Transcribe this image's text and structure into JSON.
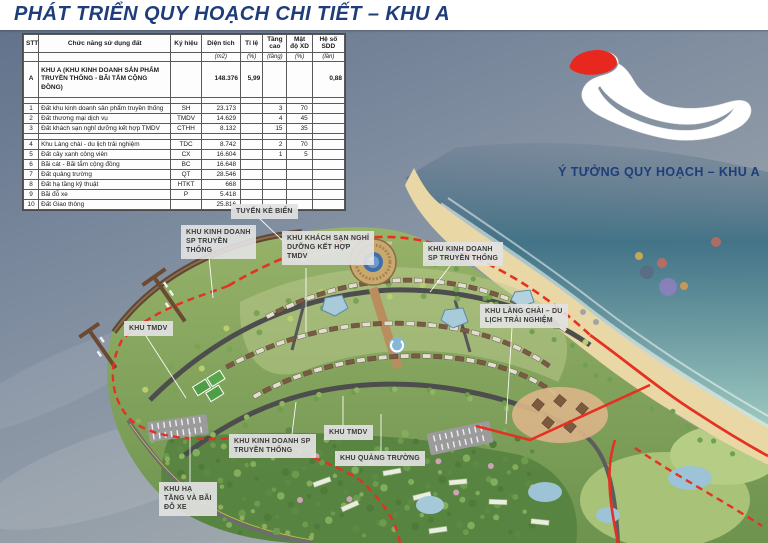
{
  "header": {
    "title": "PHÁT TRIỂN QUY HOẠCH CHI TIẾT – KHU A"
  },
  "inset": {
    "caption": "Ý TƯỞNG QUY HOẠCH – KHU A",
    "highlight_color": "#e8281e",
    "highlight_meaning": "KHU A"
  },
  "table": {
    "columns": [
      {
        "label": "STT",
        "unit": ""
      },
      {
        "label": "Chức năng sử dụng đất",
        "unit": ""
      },
      {
        "label": "Ký hiệu",
        "unit": ""
      },
      {
        "label": "Diện tích",
        "unit": "(m2)"
      },
      {
        "label": "Tỉ lệ",
        "unit": "(%)"
      },
      {
        "label": "Tầng cao",
        "unit": "(tầng)"
      },
      {
        "label": "Mật độ XD",
        "unit": "(%)"
      },
      {
        "label": "Hệ số SDD",
        "unit": "(lần)"
      }
    ],
    "summary_row": {
      "stt": "A",
      "name": "KHU A (KHU KINH DOANH SẢN PHẨM TRUYỀN THỐNG - BÃI TẮM CỘNG ĐỒNG)",
      "code": "",
      "area": "148.376",
      "ratio": "5,99",
      "floors": "",
      "density": "",
      "far": "0,88"
    },
    "rows": [
      {
        "stt": "1",
        "name": "Đất khu kinh doanh sản phẩm truyền thống",
        "code": "SH",
        "area": "23.173",
        "ratio": "",
        "floors": "3",
        "density": "70",
        "far": ""
      },
      {
        "stt": "2",
        "name": "Đất thương mại dịch vụ",
        "code": "TMDV",
        "area": "14.629",
        "ratio": "",
        "floors": "4",
        "density": "45",
        "far": ""
      },
      {
        "stt": "3",
        "name": "Đất khách sạn nghỉ dưỡng kết hợp TMDV",
        "code": "CTHH",
        "area": "8.132",
        "ratio": "",
        "floors": "15",
        "density": "35",
        "far": ""
      },
      {
        "stt": "4",
        "name": "Khu Làng chài - du lịch trải nghiệm",
        "code": "TDC",
        "area": "8.742",
        "ratio": "",
        "floors": "2",
        "density": "70",
        "far": ""
      },
      {
        "stt": "5",
        "name": "Đất cây xanh công viên",
        "code": "CX",
        "area": "16.604",
        "ratio": "",
        "floors": "1",
        "density": "5",
        "far": ""
      },
      {
        "stt": "6",
        "name": "Bãi cát - Bãi tắm cộng đồng",
        "code": "BC",
        "area": "16.648",
        "ratio": "",
        "floors": "",
        "density": "",
        "far": ""
      },
      {
        "stt": "7",
        "name": "Đất quảng trường",
        "code": "QT",
        "area": "28.546",
        "ratio": "",
        "floors": "",
        "density": "",
        "far": ""
      },
      {
        "stt": "8",
        "name": "Đất hạ tầng kỹ thuật",
        "code": "HTKT",
        "area": "668",
        "ratio": "",
        "floors": "",
        "density": "",
        "far": ""
      },
      {
        "stt": "9",
        "name": "Bãi đỗ xe",
        "code": "P",
        "area": "5.418",
        "ratio": "",
        "floors": "",
        "density": "",
        "far": ""
      },
      {
        "stt": "10",
        "name": "Đất Giao thông",
        "code": "",
        "area": "25.816",
        "ratio": "",
        "floors": "",
        "density": "",
        "far": ""
      }
    ]
  },
  "map_labels": [
    {
      "id": "tuyen-ke-bien",
      "text": "TUYẾN KÈ BIỂN"
    },
    {
      "id": "khu-kinh-doanh-sp-truyen-thong-left",
      "text": "KHU KINH DOANH\nSP TRUYỀN\nTHỐNG"
    },
    {
      "id": "khu-khach-san-nghi-duong",
      "text": "KHU KHÁCH SẠN NGHỈ\nDƯỠNG KẾT HỢP\nTMDV"
    },
    {
      "id": "khu-kinh-doanh-sp-truyen-thong-right",
      "text": "KHU KINH DOANH\nSP TRUYỀN THỐNG"
    },
    {
      "id": "khu-tmdv-left",
      "text": "KHU TMDV"
    },
    {
      "id": "khu-lang-chai",
      "text": "KHU LÀNG CHÀI – DU\nLỊCH TRẢI NGHIỆM"
    },
    {
      "id": "khu-kinh-doanh-sp-truyen-thong-bottom",
      "text": "KHU KINH DOANH SP\nTRUYỀN THỐNG"
    },
    {
      "id": "khu-tmdv-bottom",
      "text": "KHU TMDV"
    },
    {
      "id": "khu-quang-truong",
      "text": "KHU QUẢNG TRƯỜNG"
    },
    {
      "id": "khu-ha-tang-bai-do-xe",
      "text": "KHU HẠ\nTẦNG VÀ BÃI\nĐỖ XE"
    }
  ],
  "colors": {
    "title_navy": "#1e3d7a",
    "boundary_red": "#e53022",
    "sand": "#e9d8a6",
    "sea_teal": "#4d8492",
    "water_slate": "#7e8c9e",
    "land_green": "#83a45f"
  }
}
